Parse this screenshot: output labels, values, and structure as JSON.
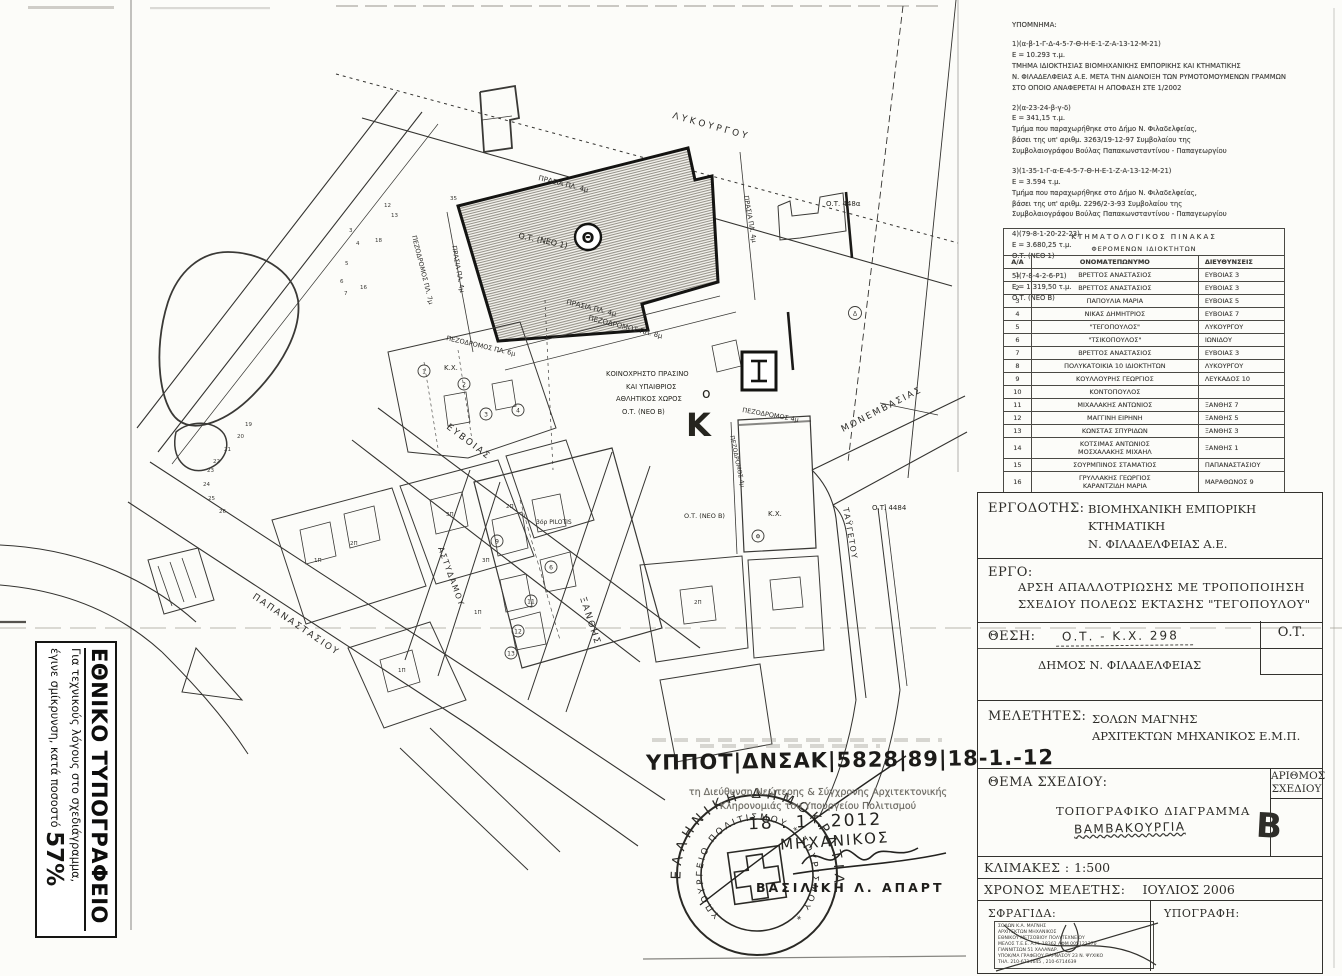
{
  "legend_notes": {
    "title": "ΥΠΟΜΝΗΜΑ:",
    "items": [
      "1)(α-β-1-Γ-Δ-4-5-7-Θ-Η-Ε-1-Ζ-Α-13-12-Μ-21)\nΕ = 10.293 τ.μ.\nΤΜΗΜΑ ΙΔΙΟΚΤΗΣΙΑΣ ΒΙΟΜΗΧΑΝΙΚΗΣ ΕΜΠΟΡΙΚΗΣ ΚΑΙ ΚΤΗΜΑΤΙΚΗΣ\nΝ. ΦΙΛΑΔΕΛΦΕΙΑΣ Α.Ε. ΜΕΤΑ ΤΗΝ ΔΙΑΝΟΙΞΗ ΤΩΝ ΡΥΜΟΤΟΜΟΥΜΕΝΩΝ ΓΡΑΜΜΩΝ\nΣΤΟ ΟΠΟΙΟ ΑΝΑΦΕΡΕΤΑΙ Η ΑΠΟΦΑΣΗ ΣΤΕ 1/2002",
      "2)(α-23-24-β-γ-δ)\nΕ = 341,15 τ.μ.\nΤμήμα που παραχωρήθηκε στο Δήμο Ν. Φιλαδελφείας,\nβάσει της υπ' αριθμ. 3263/19-12-97 Συμβολαίου της\nΣυμβολαιογράφου Βούλας Παπακωνσταντίνου - Παπαγεωργίου",
      "3)(1-35-1-Γ-α-Ε-4-5-7-Θ-Η-Ε-1-Ζ-Α-13-12-Μ-21)\nΕ = 3.594 τ.μ.\nΤμήμα που παραχωρήθηκε στο Δήμο Ν. Φιλαδελφείας,\nβάσει της υπ' αριθμ. 2296/2-3-93 Συμβολαίου της\nΣυμβολαιογράφου Βούλας Παπακωνσταντίνου - Παπαγεωργίου",
      "4)(79-8-1-20-22-23)\nΕ = 3.680,25 τ.μ.\nΟ.Τ. (ΝΕΟ 1)",
      "5)(7-8-4-2-6-Ρ1)\nΕ = 1.319,50 τ.μ.\nΟ.Τ. (ΝΕΟ Β)"
    ]
  },
  "cadastral_table": {
    "title": "ΚΤΗΜΑΤΟΛΟΓΙΚΟΣ ΠΙΝΑΚΑΣ",
    "subtitle": "ΦΕΡΟΜΕΝΩΝ ΙΔΙΟΚΤΗΤΩΝ",
    "columns": [
      "Α/Α",
      "ΟΝΟΜΑΤΕΠΩΝΥΜΟ",
      "ΔΙΕΥΘΥΝΣΕΙΣ"
    ],
    "rows": [
      {
        "num": "1",
        "name": "ΒΡΕΤΤΟΣ ΑΝΑΣΤΑΣΙΟΣ",
        "addr": "ΕΥΒΟΙΑΣ 3"
      },
      {
        "num": "2",
        "name": "ΒΡΕΤΤΟΣ ΑΝΑΣΤΑΣΙΟΣ",
        "addr": "ΕΥΒΟΙΑΣ 3"
      },
      {
        "num": "3",
        "name": "ΠΑΠΟΥΛΙΑ ΜΑΡΙΑ",
        "addr": "ΕΥΒΟΙΑΣ 5"
      },
      {
        "num": "4",
        "name": "ΝΙΚΑΣ ΔΗΜΗΤΡΙΟΣ",
        "addr": "ΕΥΒΟΙΑΣ 7"
      },
      {
        "num": "5",
        "name": "\"ΤΕΓΟΠΟΥΛΟΣ\"",
        "addr": "ΛΥΚΟΥΡΓΟΥ"
      },
      {
        "num": "6",
        "name": "\"ΤΣΙΚΟΠΟΥΛΟΣ\"",
        "addr": "ΙΩΝΙΔΟΥ"
      },
      {
        "num": "7",
        "name": "ΒΡΕΤΤΟΣ ΑΝΑΣΤΑΣΙΟΣ",
        "addr": "ΕΥΒΟΙΑΣ 3"
      },
      {
        "num": "8",
        "name": "ΠΟΛΥΚΑΤΟΙΚΙΑ 10 ΙΔΙΟΚΤΗΤΩΝ",
        "addr": "ΛΥΚΟΥΡΓΟΥ"
      },
      {
        "num": "9",
        "name": "ΚΟΥΛΛΟΥΡΗΣ ΓΕΩΡΓΙΟΣ",
        "addr": "ΛΕΥΚΑΔΟΣ 10"
      },
      {
        "num": "10",
        "name": "ΚΟΝΤΟΠΟΥΛΟΣ",
        "addr": ""
      },
      {
        "num": "11",
        "name": "ΜΙΧΑΛΑΚΗΣ ΑΝΤΩΝΙΟΣ",
        "addr": "ΞΑΝΘΗΣ 7"
      },
      {
        "num": "12",
        "name": "ΜΑΓΓΙΝΗ ΕΙΡΗΝΗ",
        "addr": "ΞΑΝΘΗΣ 5"
      },
      {
        "num": "13",
        "name": "ΚΩΝΣΤΑΣ ΣΠΥΡΙΔΩΝ",
        "addr": "ΞΑΝΘΗΣ 3"
      },
      {
        "num": "14",
        "name": "ΚΟΤΣΙΜΑΣ ΑΝΤΩΝΙΟΣ\nΜΟΣΧΑΛΑΚΗΣ ΜΙΧΑΗΛ",
        "addr": "ΞΑΝΘΗΣ 1"
      },
      {
        "num": "15",
        "name": "ΣΟΥΡΜΠΙΝΟΣ ΣΤΑΜΑΤΙΟΣ",
        "addr": "ΠΑΠΑΝΑΣΤΑΣΙΟΥ"
      },
      {
        "num": "16",
        "name": "ΓΡΥΛΛΑΚΗΣ ΓΕΩΡΓΙΟΣ\nΚΑΡΑΝΤΖΙΔΗ ΜΑΡΙΑ",
        "addr": "ΜΑΡΑΘΩΝΟΣ 9"
      }
    ]
  },
  "title_block": {
    "employer_label": "ΕΡΓΟΔΟΤΗΣ:",
    "employer": "ΒΙΟΜΗΧΑΝΙΚΗ ΕΜΠΟΡΙΚΗ ΚΤΗΜΑΤΙΚΗ\nΝ. ΦΙΛΑΔΕΛΦΕΙΑΣ Α.Ε.",
    "project_label": "ΕΡΓΟ:",
    "project": "ΑΡΣΗ ΑΠΑΛΛΟΤΡΙΩΣΗΣ ΜΕ ΤΡΟΠΟΠΟΙΗΣΗ\nΣΧΕΔΙΟΥ ΠΟΛΕΩΣ ΕΚΤΑΣΗΣ \"ΤΕΓΟΠΟΥΛΟΥ\"",
    "location_label": "ΘΕΣΗ:",
    "location_hand": "Ο.Τ. - Κ.Χ. 298",
    "municipality": "ΔΗΜΟΣ Ν. ΦΙΛΑΔΕΛΦΕΙΑΣ",
    "ot_box": "Ο.Τ.",
    "designers_label": "ΜΕΛΕΤΗΤΕΣ:",
    "designers": "ΣΟΛΩΝ  ΜΑΓΝΗΣ\nΑΡΧΙΤΕΚΤΩΝ ΜΗΧΑΝΙΚΟΣ Ε.Μ.Π.",
    "subject_label": "ΘΕΜΑ ΣΧΕΔΙΟΥ:",
    "subject": "ΤΟΠΟΓΡΑΦΙΚΟ ΔΙΑΓΡΑΜΜΑ",
    "subject_hand": "ΒΑΜΒΑΚΟΥΡΓΙΑ",
    "number_label": "ΑΡΙΘΜΟΣ\nΣΧΕΔΙΟΥ",
    "number_hand": "B",
    "scale_label": "ΚΛΙΜΑΚΕΣ : ",
    "scale_value": "1:500",
    "time_label": "ΧΡΟΝΟΣ ΜΕΛΕΤΗΣ:",
    "time_value": "ΙΟΥΛΙΟΣ 2006",
    "stamp_label": "ΣΦΡΑΓΙΔΑ:",
    "signature_label": "ΥΠΟΓΡΑΦΗ:",
    "stamp_text": "ΣΟΛΩΝ Κ.Α. ΜΑΓΝΗΣ\nΑΡΧΙΤΕΚΤΩΝ ΜΗΧΑΝΙΚΟΣ\nΕΘΝΙΚΟΥ ΜΕΤΣΟΒΙΟΥ ΠΟΛΥΤΕΧΝΕΙΟΥ\nΜΕΛΟΣ Τ.Ε.Ε. Α.Μ. 18362  ΑΦΜ 005121370\nΓΙΑΝΝΙΤΣΩΝ 51  ΧΑΛΑΝΔΡ.\nΥΠΟΚ/ΜΑ ΓΡΑΦΕΙΟΥ ΠΑΡΝΑΣΟΥ 23 Ν. ΨΥΧΙΚΟ\nΤΗΛ. 210-6714645 , 210-6714639"
  },
  "reduction_box": {
    "title": "ΕΘΝΙΚΟ ΤΥΠΟΓΡΑΦΕΙΟ",
    "line1": "Για τεχνικούς λόγους στο σχεδιάγραμμα,",
    "line2": "έγινε σμίκρυνση, κατά ποσοστό ",
    "percent": "57%"
  },
  "approval": {
    "protocol": "ΥΠΠΟΤ|ΔΝΣΑΚ|5828|89|18-1.-12",
    "dept": "τη Διεύθυνση Νεώτερης & Σύγχρονης Αρχιτεκτονικής\nΚληρονομιάς του Υπουργείου Πολιτισμού",
    "date_hand": "18 . 1 . 2012",
    "stamp_outer": "ΕΛΛΗΝΙΚΗ ΔΗΜΟΚΡΑΤΙΑ",
    "stamp_inner": "ΥΠΟΥΡΓΕΙΟ ΠΟΛΙΤΙΣΜΟΥ * ΤΟΥΡΙΣΜΟΥ *",
    "engineer_hand": "ΜΗΧΑΝΙΚΟΣ",
    "signer_name": "ΒΑΣΙΛΙΚΗ Λ. ΑΠΑΡΤ"
  },
  "map": {
    "streets": {
      "lykourgou": "ΛΥΚΟΥΡΓΟΥ",
      "papanastasiou": "ΠΑΠΑΝΑΣΤΑΣΙΟΥ",
      "evvoias": "ΕΥΒΟΙΑΣ",
      "xanthis": "ΞΑΝΘΗΣ",
      "monemvasias": "ΜΟΝΕΜΒΑΣΙΑΣ",
      "astydamou": "ΑΣΤΥΔΑΜΟΥ",
      "taygetou": "ΤΑΫΓΕΤΟΥ",
      "pez8": "ΠΕΖΟΔΡΟΜΟΣ ΠΛ. 8μ",
      "pez7": "ΠΕΖΟΔΡΟΜΟΣ ΠΛ. 7μ",
      "pez6": "ΠΕΖΟΔΡΟΜΟΣ ΠΛ. 6μ",
      "pez4": "ΠΕΖΟΔΡΟΜΟΣ 4μ",
      "prasia4": "ΠΡΑΣΙΑ ΠΛ. 4μ"
    },
    "blocks": {
      "ot_neo1": "Ο.Τ. (ΝΕΟ 1)",
      "ot_neo_b": "Ο.Τ. (ΝΕΟ Β)",
      "ot_448a": "Ο.Τ. 448α",
      "ot_4484": "Ο.Τ. 4484",
      "kx": "Κ.Χ.",
      "green1": "ΚΟΙΝΟΧΡΗΣΤΟ ΠΡΑΣΙΝΟ",
      "green2": "ΚΑΙ ΥΠΑΙΘΡΙΟΣ",
      "green3": "ΑΘΛΗΤΙΚΟΣ ΧΩΡΟΣ",
      "pilotis": "3όρ PILOTIS",
      "theta": "Θ",
      "big_k": "Κ",
      "small_o": "ο"
    },
    "floors": [
      "2Π",
      "3Π",
      "1Π",
      "2Π",
      "1Π",
      "3Π",
      "2Π",
      "1Π"
    ],
    "points": [
      "19",
      "20",
      "21",
      "22",
      "23",
      "24",
      "25",
      "26",
      "3",
      "4",
      "5",
      "6",
      "7",
      "16",
      "18",
      "13",
      "12",
      "35"
    ],
    "circled": [
      "1",
      "2",
      "3",
      "4",
      "9",
      "6",
      "11",
      "12",
      "13",
      "Δ",
      "Φ"
    ]
  }
}
